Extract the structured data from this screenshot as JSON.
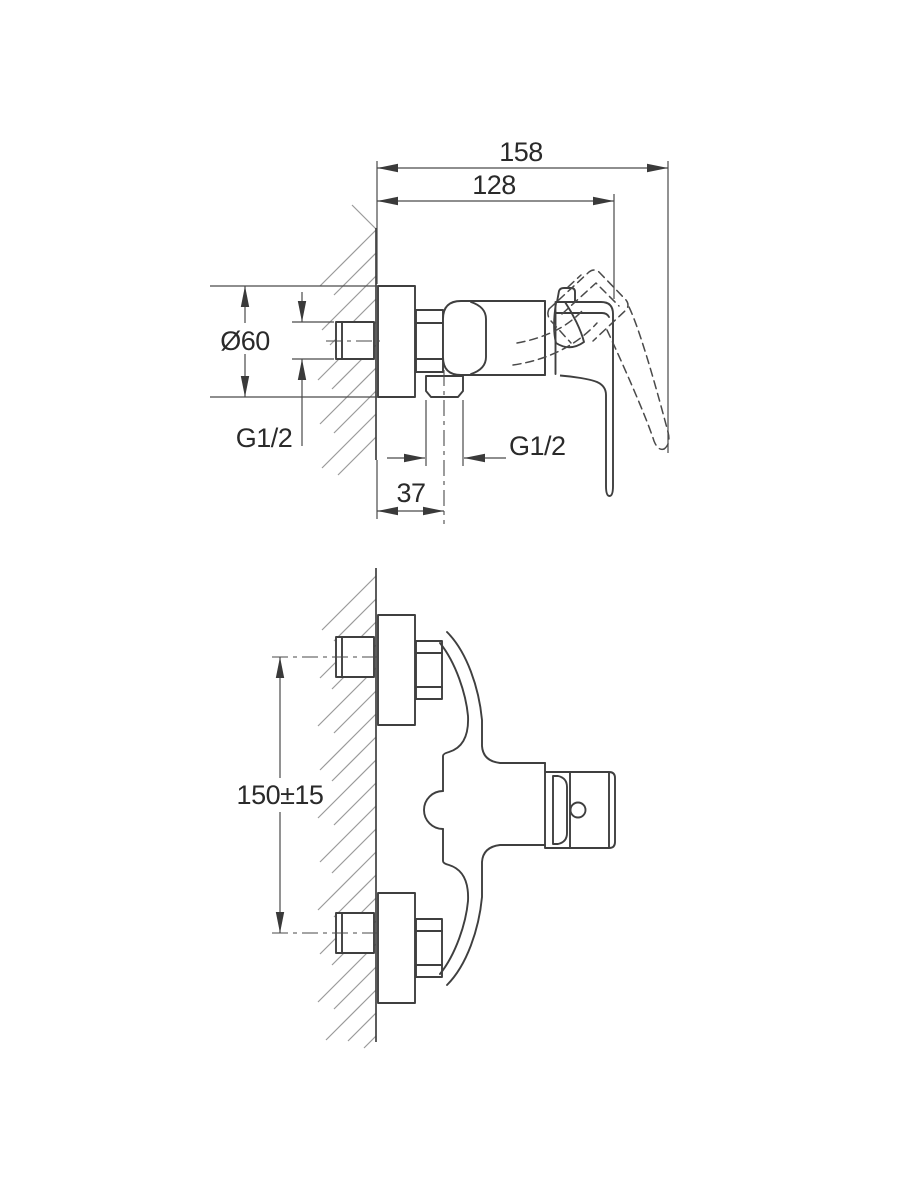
{
  "colors": {
    "background": "#ffffff",
    "line": "#3f3f3f",
    "dim": "#4a4a4a",
    "text": "#2a2a2a",
    "hatch": "#9a9a9a",
    "arrow": "#3a3a3a"
  },
  "views": {
    "side": {
      "dims": {
        "overall_depth": "158",
        "body_depth": "128",
        "escutcheon_diameter": "Ø60",
        "inlet_thread": "G1/2",
        "outlet_thread": "G1/2",
        "outlet_offset": "37"
      }
    },
    "plan": {
      "dims": {
        "connection_spacing": "150±15"
      }
    }
  }
}
